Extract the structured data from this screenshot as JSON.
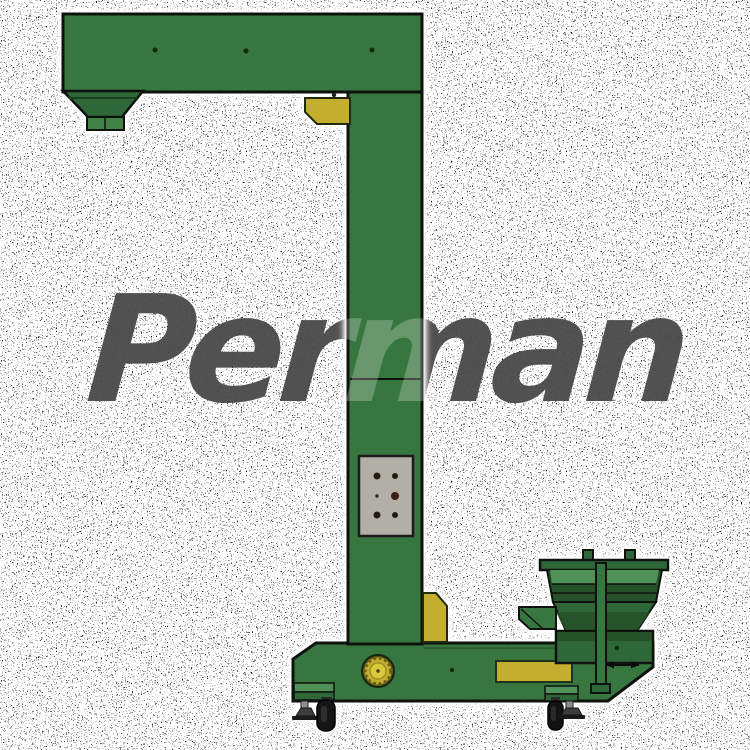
{
  "image": {
    "subject": "Z-type bucket elevator with feed hopper and wheeled base",
    "background_style": "white with dense black speckle noise"
  },
  "watermark": {
    "text": "Perman"
  },
  "colors": {
    "machine-green": "#38763F",
    "machine-green-dark": "#255229",
    "machine-green-mid": "#2F6838",
    "machine-green-light": "#4F9157",
    "accent-yellow": "#C3AE2D",
    "accent-yellow-bright": "#DBC93C",
    "panel-gray": "#B2AFA7",
    "outline-ink": "#0E120D",
    "watermark-dark": "#0A0A0A",
    "background": "#FFFFFF"
  },
  "machine": {
    "parts": [
      "top-discharge-arm",
      "discharge-hopper",
      "vertical-column",
      "control-panel",
      "feed-hopper",
      "base-frame",
      "drive-sprocket",
      "caster-wheels",
      "leveling-feet",
      "yellow-corner-block-top",
      "yellow-corner-block-bottom",
      "yellow-access-plate"
    ]
  }
}
